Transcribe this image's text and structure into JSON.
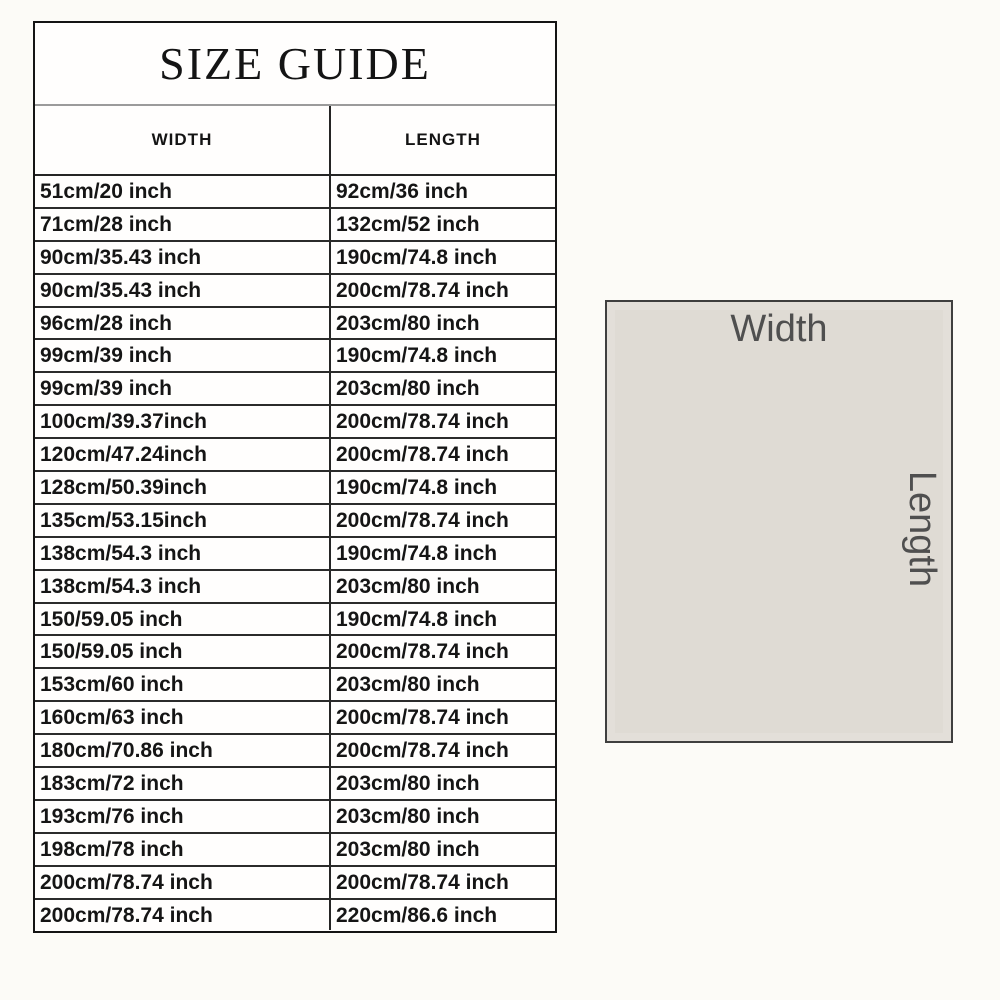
{
  "page": {
    "background": "#fcfbf7",
    "table_background": "#fffefd"
  },
  "size_guide": {
    "title": "SIZE GUIDE",
    "columns": {
      "width": "WIDTH",
      "length": "LENGTH"
    },
    "rows": [
      [
        "51cm/20 inch",
        "92cm/36 inch"
      ],
      [
        "71cm/28 inch",
        "132cm/52 inch"
      ],
      [
        "90cm/35.43 inch",
        "190cm/74.8 inch"
      ],
      [
        "90cm/35.43 inch",
        "200cm/78.74 inch"
      ],
      [
        "96cm/28 inch",
        "203cm/80 inch"
      ],
      [
        "99cm/39 inch",
        "190cm/74.8 inch"
      ],
      [
        "99cm/39 inch",
        "203cm/80 inch"
      ],
      [
        "100cm/39.37inch",
        "200cm/78.74 inch"
      ],
      [
        "120cm/47.24inch",
        "200cm/78.74 inch"
      ],
      [
        "128cm/50.39inch",
        "190cm/74.8 inch"
      ],
      [
        "135cm/53.15inch",
        "200cm/78.74 inch"
      ],
      [
        "138cm/54.3 inch",
        "190cm/74.8 inch"
      ],
      [
        "138cm/54.3 inch",
        "203cm/80 inch"
      ],
      [
        "150/59.05 inch",
        "190cm/74.8 inch"
      ],
      [
        "150/59.05 inch",
        "200cm/78.74 inch"
      ],
      [
        "153cm/60 inch",
        "203cm/80 inch"
      ],
      [
        "160cm/63 inch",
        "200cm/78.74 inch"
      ],
      [
        "180cm/70.86 inch",
        "200cm/78.74 inch"
      ],
      [
        "183cm/72 inch",
        "203cm/80 inch"
      ],
      [
        "193cm/76 inch",
        "203cm/80 inch"
      ],
      [
        "198cm/78 inch",
        "203cm/80 inch"
      ],
      [
        "200cm/78.74 inch",
        "200cm/78.74 inch"
      ],
      [
        "200cm/78.74 inch",
        "220cm/86.6 inch"
      ]
    ]
  },
  "diagram": {
    "width_label": "Width",
    "length_label": "Length",
    "fill_color": "#dfdbd4",
    "border_color": "#3f3f3f",
    "label_color": "#4f4f4f"
  }
}
